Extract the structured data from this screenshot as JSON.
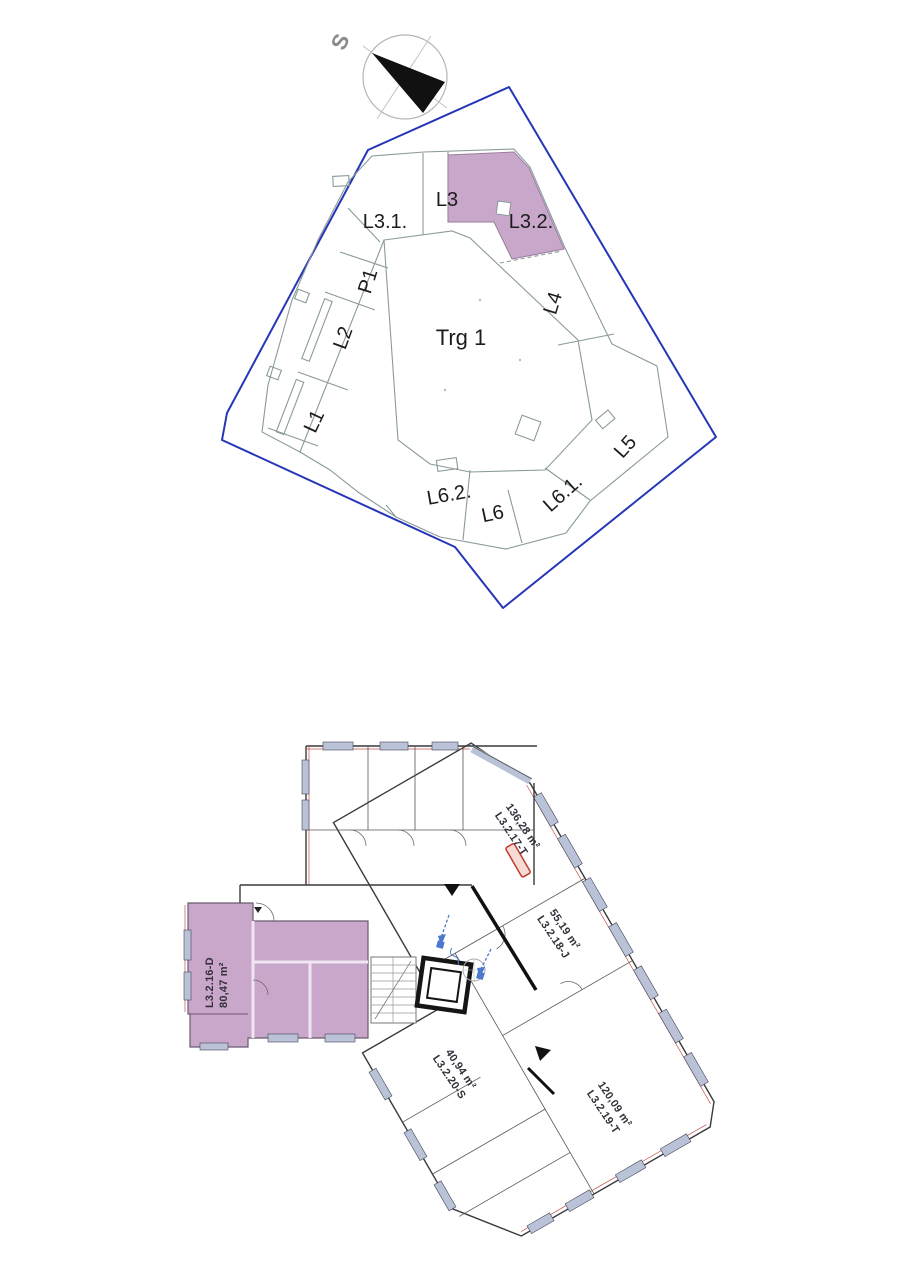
{
  "sheet": {
    "background": "#ffffff"
  },
  "site_plan": {
    "compass_label": "S",
    "courtyard_label": "Trg 1",
    "boundary_color": "#2536b8",
    "highlight_color": "#c9a7cb",
    "blocks": [
      {
        "label": "L3.1.",
        "highlighted": false
      },
      {
        "label": "L3",
        "highlighted": false
      },
      {
        "label": "L3.2.",
        "highlighted": true
      },
      {
        "label": "P1",
        "highlighted": false
      },
      {
        "label": "L2",
        "highlighted": false
      },
      {
        "label": "L1",
        "highlighted": false
      },
      {
        "label": "L4",
        "highlighted": false
      },
      {
        "label": "L5",
        "highlighted": false
      },
      {
        "label": "L6.1.",
        "highlighted": false
      },
      {
        "label": "L6",
        "highlighted": false
      },
      {
        "label": "L6.2.",
        "highlighted": false
      }
    ]
  },
  "floor_plan": {
    "highlight_color": "#c9a7cb",
    "window_color": "#b9c2d6",
    "accent_red": "#c4524a",
    "annotation_blue": "#4b79cf",
    "units": [
      {
        "id": "L3.2.16-D",
        "area": "80,47 m²",
        "highlighted": true
      },
      {
        "id": "L3.2.17-T",
        "area": "136,28 m²",
        "highlighted": false
      },
      {
        "id": "L3.2.18-J",
        "area": "55,19 m²",
        "highlighted": false
      },
      {
        "id": "L3.2.19-T",
        "area": "120,09 m²",
        "highlighted": false
      },
      {
        "id": "L3.2.20-S",
        "area": "40,94 m²",
        "highlighted": false
      }
    ]
  }
}
